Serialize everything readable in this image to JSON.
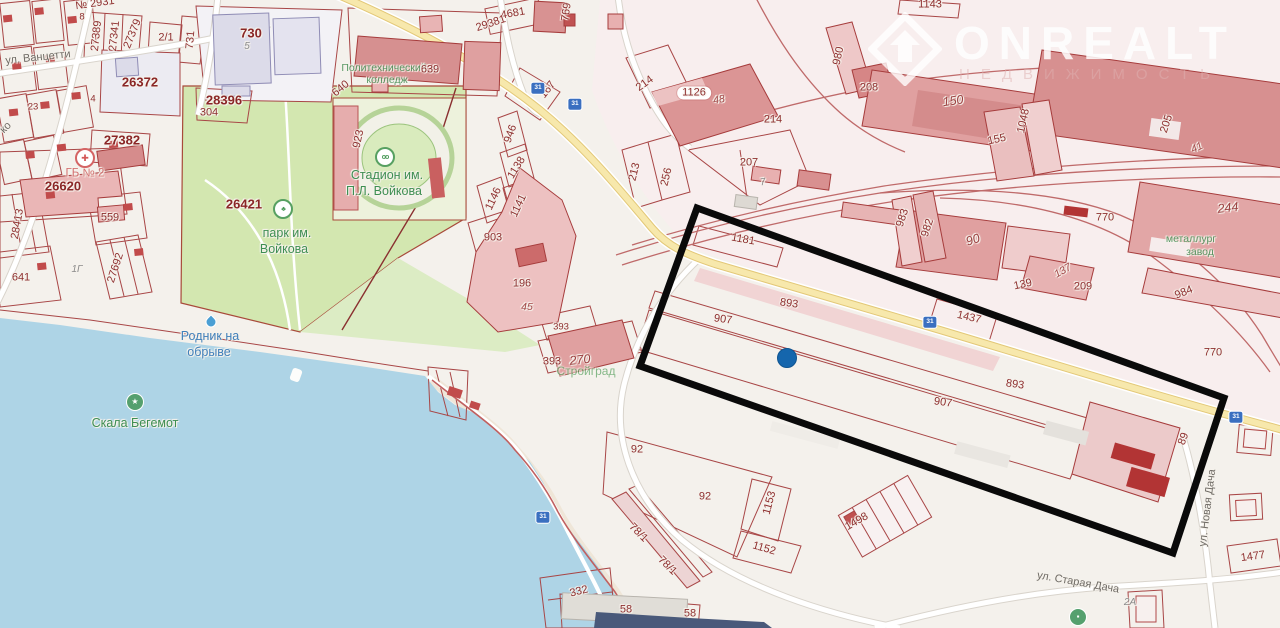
{
  "watermark": {
    "brand": "ONREALT",
    "subtitle": "НЕДВИЖИМОСТЬ"
  },
  "colors": {
    "background": "#f4f1ec",
    "water": "#aed4e6",
    "park_green": "#d3e7b0",
    "highway_yellow": "#f7e8ac",
    "parcel_line": "#a84646",
    "building_pink": "#e0a0a0",
    "building_dark_red": "#b23434",
    "highlight_black": "#0a0a0a",
    "marker_blue": "#1566ad"
  },
  "map": {
    "marker": {
      "x": 787,
      "y": 358,
      "color": "#1566ad"
    },
    "highlight": {
      "points": "697,208 1224,398 1173,553 640,366",
      "stroke": "#0a0a0a",
      "stroke_width": 7
    },
    "labels": [
      {
        "text": "№ 2931",
        "x": 95,
        "y": 4,
        "rot": -8,
        "kind": "parcel"
      },
      {
        "text": "8",
        "x": 82,
        "y": 17,
        "rot": 0,
        "kind": "parcel-sm"
      },
      {
        "text": "27389",
        "x": 97,
        "y": 36,
        "rot": -84,
        "kind": "parcel"
      },
      {
        "text": "27341",
        "x": 115,
        "y": 36,
        "rot": -84,
        "kind": "parcel"
      },
      {
        "text": "27379",
        "x": 133,
        "y": 34,
        "rot": -68,
        "kind": "parcel"
      },
      {
        "text": "2/1",
        "x": 166,
        "y": 38,
        "rot": 0,
        "kind": "parcel"
      },
      {
        "text": "731",
        "x": 191,
        "y": 40,
        "rot": -85,
        "kind": "parcel"
      },
      {
        "text": "730",
        "x": 251,
        "y": 33,
        "rot": 0,
        "kind": "parcel-lg"
      },
      {
        "text": "5",
        "x": 247,
        "y": 47,
        "rot": 0,
        "kind": "bldg"
      },
      {
        "text": "ул. Ванцетти",
        "x": 38,
        "y": 58,
        "rot": -6,
        "kind": "street"
      },
      {
        "text": "26372",
        "x": 140,
        "y": 82,
        "rot": 0,
        "kind": "parcel-lg"
      },
      {
        "text": "4",
        "x": 93,
        "y": 99,
        "rot": 0,
        "kind": "parcel-sm"
      },
      {
        "text": "23",
        "x": 33,
        "y": 107,
        "rot": 0,
        "kind": "parcel-sm"
      },
      {
        "text": "28396",
        "x": 224,
        "y": 100,
        "rot": 0,
        "kind": "parcel-lg"
      },
      {
        "text": "304",
        "x": 209,
        "y": 113,
        "rot": 0,
        "kind": "parcel"
      },
      {
        "text": "27382",
        "x": 122,
        "y": 140,
        "rot": 0,
        "kind": "parcel-lg"
      },
      {
        "text": "ко",
        "x": 6,
        "y": 128,
        "rot": -45,
        "kind": "street"
      },
      {
        "text": "ГБ № 2",
        "x": 85,
        "y": 174,
        "rot": 0,
        "kind": "poi-red"
      },
      {
        "text": "26620",
        "x": 63,
        "y": 186,
        "rot": 0,
        "kind": "parcel-lg"
      },
      {
        "text": "559",
        "x": 110,
        "y": 218,
        "rot": 0,
        "kind": "parcel"
      },
      {
        "text": "28413",
        "x": 18,
        "y": 224,
        "rot": -80,
        "kind": "parcel"
      },
      {
        "text": "641",
        "x": 21,
        "y": 278,
        "rot": 0,
        "kind": "parcel"
      },
      {
        "text": "27692",
        "x": 116,
        "y": 268,
        "rot": -72,
        "kind": "parcel"
      },
      {
        "text": "1Г",
        "x": 77,
        "y": 270,
        "rot": 0,
        "kind": "bldg"
      },
      {
        "text": "26421",
        "x": 244,
        "y": 204,
        "rot": 0,
        "kind": "parcel-lg"
      },
      {
        "text": "парк им.",
        "x": 287,
        "y": 233,
        "rot": 0,
        "kind": "poi-green"
      },
      {
        "text": "Войкова",
        "x": 284,
        "y": 249,
        "rot": 0,
        "kind": "poi-green"
      },
      {
        "text": "923",
        "x": 359,
        "y": 139,
        "rot": -78,
        "kind": "parcel"
      },
      {
        "text": "Политехнический",
        "x": 384,
        "y": 68,
        "rot": 0,
        "kind": "poi-green-sm"
      },
      {
        "text": "колледж",
        "x": 387,
        "y": 80,
        "rot": 0,
        "kind": "poi-green-sm"
      },
      {
        "text": "639",
        "x": 430,
        "y": 70,
        "rot": 0,
        "kind": "parcel"
      },
      {
        "text": "640",
        "x": 341,
        "y": 89,
        "rot": -40,
        "kind": "parcel"
      },
      {
        "text": "Стадион им.",
        "x": 387,
        "y": 175,
        "rot": 0,
        "kind": "poi-green"
      },
      {
        "text": "П.Л. Войкова",
        "x": 384,
        "y": 191,
        "rot": 0,
        "kind": "poi-green"
      },
      {
        "text": "946",
        "x": 511,
        "y": 134,
        "rot": -70,
        "kind": "parcel"
      },
      {
        "text": "1138",
        "x": 517,
        "y": 168,
        "rot": -58,
        "kind": "parcel"
      },
      {
        "text": "1146",
        "x": 494,
        "y": 199,
        "rot": -65,
        "kind": "parcel"
      },
      {
        "text": "1141",
        "x": 519,
        "y": 206,
        "rot": -65,
        "kind": "parcel"
      },
      {
        "text": "903",
        "x": 493,
        "y": 238,
        "rot": 0,
        "kind": "parcel"
      },
      {
        "text": "196",
        "x": 522,
        "y": 284,
        "rot": 0,
        "kind": "parcel"
      },
      {
        "text": "45",
        "x": 527,
        "y": 307,
        "rot": 0,
        "kind": "bldg-red"
      },
      {
        "text": "393",
        "x": 561,
        "y": 327,
        "rot": 0,
        "kind": "parcel-sm"
      },
      {
        "text": "393",
        "x": 552,
        "y": 362,
        "rot": 0,
        "kind": "parcel"
      },
      {
        "text": "270",
        "x": 580,
        "y": 360,
        "rot": -6,
        "kind": "bldg-red-lg"
      },
      {
        "text": "Стройград",
        "x": 586,
        "y": 371,
        "rot": 0,
        "kind": "poi-green-faded"
      },
      {
        "text": "Родник на",
        "x": 210,
        "y": 336,
        "rot": 0,
        "kind": "poi-blue"
      },
      {
        "text": "обрыве",
        "x": 209,
        "y": 352,
        "rot": 0,
        "kind": "poi-blue"
      },
      {
        "text": "Скала Бегемот",
        "x": 135,
        "y": 423,
        "rot": 0,
        "kind": "poi-green"
      },
      {
        "text": "4681",
        "x": 513,
        "y": 14,
        "rot": -10,
        "kind": "parcel"
      },
      {
        "text": "29381",
        "x": 491,
        "y": 24,
        "rot": -18,
        "kind": "parcel"
      },
      {
        "text": "769",
        "x": 567,
        "y": 12,
        "rot": -82,
        "kind": "parcel"
      },
      {
        "text": "167",
        "x": 548,
        "y": 90,
        "rot": -52,
        "kind": "parcel"
      },
      {
        "text": "214",
        "x": 645,
        "y": 84,
        "rot": -36,
        "kind": "parcel"
      },
      {
        "text": "1126",
        "x": 694,
        "y": 93,
        "rot": 0,
        "kind": "parcel-pill"
      },
      {
        "text": "48",
        "x": 719,
        "y": 100,
        "rot": -10,
        "kind": "bldg-red"
      },
      {
        "text": "214",
        "x": 773,
        "y": 120,
        "rot": 0,
        "kind": "parcel"
      },
      {
        "text": "207",
        "x": 749,
        "y": 163,
        "rot": 0,
        "kind": "parcel"
      },
      {
        "text": "7",
        "x": 763,
        "y": 183,
        "rot": -10,
        "kind": "bldg"
      },
      {
        "text": "213",
        "x": 635,
        "y": 172,
        "rot": -76,
        "kind": "parcel"
      },
      {
        "text": "256",
        "x": 667,
        "y": 177,
        "rot": -76,
        "kind": "parcel"
      },
      {
        "text": "1143",
        "x": 930,
        "y": 5,
        "rot": 0,
        "kind": "parcel"
      },
      {
        "text": "980",
        "x": 839,
        "y": 56,
        "rot": -78,
        "kind": "parcel"
      },
      {
        "text": "208",
        "x": 869,
        "y": 88,
        "rot": 0,
        "kind": "parcel"
      },
      {
        "text": "150",
        "x": 953,
        "y": 101,
        "rot": -8,
        "kind": "bldg-red-lg"
      },
      {
        "text": "155",
        "x": 997,
        "y": 140,
        "rot": -12,
        "kind": "parcel"
      },
      {
        "text": "1048",
        "x": 1024,
        "y": 121,
        "rot": -78,
        "kind": "parcel"
      },
      {
        "text": "983",
        "x": 903,
        "y": 218,
        "rot": -72,
        "kind": "parcel"
      },
      {
        "text": "982",
        "x": 928,
        "y": 228,
        "rot": -72,
        "kind": "parcel"
      },
      {
        "text": "90",
        "x": 973,
        "y": 240,
        "rot": -18,
        "kind": "bldg-red-lg"
      },
      {
        "text": "770",
        "x": 1105,
        "y": 218,
        "rot": 0,
        "kind": "parcel"
      },
      {
        "text": "137",
        "x": 1063,
        "y": 271,
        "rot": -30,
        "kind": "bldg-red"
      },
      {
        "text": "139",
        "x": 1023,
        "y": 285,
        "rot": -12,
        "kind": "parcel"
      },
      {
        "text": "209",
        "x": 1083,
        "y": 287,
        "rot": 0,
        "kind": "parcel"
      },
      {
        "text": "205",
        "x": 1167,
        "y": 124,
        "rot": -72,
        "kind": "parcel"
      },
      {
        "text": "41",
        "x": 1197,
        "y": 148,
        "rot": -25,
        "kind": "bldg-red"
      },
      {
        "text": "244",
        "x": 1228,
        "y": 208,
        "rot": -6,
        "kind": "bldg-red-lg"
      },
      {
        "text": "металлург",
        "x": 1191,
        "y": 239,
        "rot": 0,
        "kind": "poi-green-sm"
      },
      {
        "text": "завод",
        "x": 1200,
        "y": 252,
        "rot": 0,
        "kind": "poi-green-sm"
      },
      {
        "text": "984",
        "x": 1184,
        "y": 293,
        "rot": -22,
        "kind": "parcel"
      },
      {
        "text": "770",
        "x": 1213,
        "y": 353,
        "rot": 0,
        "kind": "parcel"
      },
      {
        "text": "1181",
        "x": 743,
        "y": 240,
        "rot": 10,
        "kind": "parcel"
      },
      {
        "text": "893",
        "x": 789,
        "y": 304,
        "rot": 8,
        "kind": "parcel"
      },
      {
        "text": "907",
        "x": 723,
        "y": 320,
        "rot": 8,
        "kind": "parcel"
      },
      {
        "text": "1437",
        "x": 969,
        "y": 318,
        "rot": 13,
        "kind": "parcel"
      },
      {
        "text": "893",
        "x": 1015,
        "y": 385,
        "rot": 8,
        "kind": "parcel"
      },
      {
        "text": "907",
        "x": 943,
        "y": 403,
        "rot": 8,
        "kind": "parcel"
      },
      {
        "text": "89",
        "x": 1184,
        "y": 439,
        "rot": -70,
        "kind": "parcel"
      },
      {
        "text": "ул. Новая Дача",
        "x": 1208,
        "y": 508,
        "rot": -83,
        "kind": "street"
      },
      {
        "text": "1477",
        "x": 1253,
        "y": 557,
        "rot": -8,
        "kind": "parcel"
      },
      {
        "text": "2А",
        "x": 1130,
        "y": 603,
        "rot": 0,
        "kind": "bldg"
      },
      {
        "text": "ул. Старая Дача",
        "x": 1078,
        "y": 583,
        "rot": 10,
        "kind": "street"
      },
      {
        "text": "92",
        "x": 637,
        "y": 450,
        "rot": 0,
        "kind": "parcel"
      },
      {
        "text": "92",
        "x": 705,
        "y": 497,
        "rot": 0,
        "kind": "parcel"
      },
      {
        "text": "1153",
        "x": 770,
        "y": 503,
        "rot": -75,
        "kind": "parcel"
      },
      {
        "text": "1152",
        "x": 764,
        "y": 549,
        "rot": 16,
        "kind": "parcel"
      },
      {
        "text": "78/1",
        "x": 638,
        "y": 533,
        "rot": 45,
        "kind": "parcel"
      },
      {
        "text": "78/1",
        "x": 667,
        "y": 566,
        "rot": 45,
        "kind": "parcel"
      },
      {
        "text": "1498",
        "x": 857,
        "y": 522,
        "rot": -30,
        "kind": "parcel"
      },
      {
        "text": "332",
        "x": 579,
        "y": 592,
        "rot": -14,
        "kind": "parcel"
      },
      {
        "text": "58",
        "x": 626,
        "y": 610,
        "rot": 0,
        "kind": "parcel"
      },
      {
        "text": "58",
        "x": 690,
        "y": 614,
        "rot": 0,
        "kind": "parcel"
      },
      {
        "text": "31",
        "x": 538,
        "y": 88,
        "rot": 0,
        "kind": "road-sign"
      },
      {
        "text": "31",
        "x": 575,
        "y": 104,
        "rot": 0,
        "kind": "road-sign"
      },
      {
        "text": "31",
        "x": 930,
        "y": 322,
        "rot": 0,
        "kind": "road-sign"
      },
      {
        "text": "31",
        "x": 1236,
        "y": 417,
        "rot": 0,
        "kind": "road-sign"
      },
      {
        "text": "31",
        "x": 543,
        "y": 517,
        "rot": 0,
        "kind": "road-sign"
      }
    ],
    "icons": [
      {
        "name": "stadium-icon",
        "glyph": "oo",
        "x": 385,
        "y": 157,
        "kind": "poi-circle-green"
      },
      {
        "name": "park-tree-icon",
        "glyph": "♣",
        "x": 283,
        "y": 209,
        "kind": "poi-circle-green"
      },
      {
        "name": "hospital-cross-icon",
        "glyph": "✚",
        "x": 85,
        "y": 158,
        "kind": "poi-circle-red"
      },
      {
        "name": "rock-star-icon",
        "glyph": "★",
        "x": 135,
        "y": 402,
        "kind": "poi-circle-green-solid"
      },
      {
        "name": "spring-drop-icon",
        "glyph": "",
        "x": 211,
        "y": 322,
        "kind": "poi-drop"
      },
      {
        "name": "shop-icon",
        "glyph": "▪",
        "x": 1078,
        "y": 617,
        "kind": "poi-circle-green-solid"
      },
      {
        "name": "buoy-icon",
        "glyph": "",
        "x": 296,
        "y": 375,
        "kind": "white-diamond"
      }
    ]
  }
}
